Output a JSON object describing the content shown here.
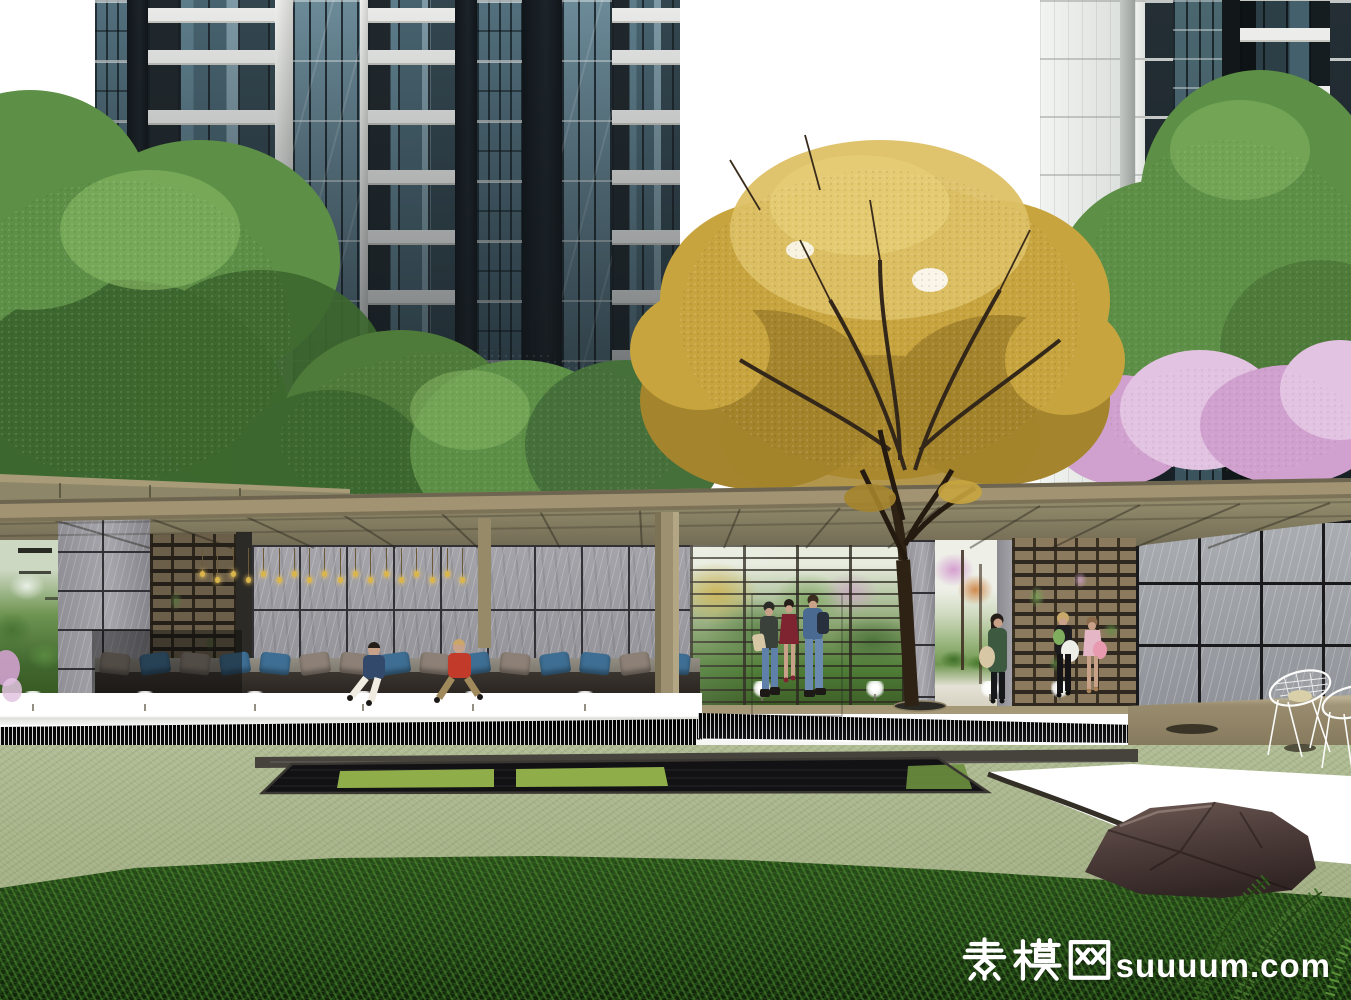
{
  "watermark": {
    "text_cn": "素模网",
    "text_en": "suuuum.com",
    "full": "素模网suuuum.com",
    "color": "#ffffff"
  },
  "scene": {
    "pendant_count": 18,
    "fountain_x": [
      33,
      145,
      255,
      363,
      473,
      585,
      762,
      875,
      990,
      1060
    ],
    "pillows": [
      "gray",
      "blue",
      "gray",
      "blue",
      "blue",
      "gray",
      "gray",
      "blue",
      "gray",
      "blue",
      "gray",
      "blue",
      "blue",
      "gray",
      "blue"
    ]
  },
  "colors": {
    "sky": "#ffffff",
    "lawn": "#a6b288",
    "hedge": "#1c3a12",
    "hedge_light": "#3f7a24",
    "roof_fascia": "#a29472",
    "soffit": "#8a8164",
    "soffit_dark": "#6b6450",
    "column_tan": "#9d9070",
    "deck": "#9a8d6f",
    "deck_face": "#857857",
    "marble": "#9b9ba0",
    "marble_joint": "#323236",
    "marble_right": "#a2a6aa",
    "lattice": "#8b7a5e",
    "lattice_dark": "#2e2820",
    "glass_teal": "#51707d",
    "glass_dark": "#1b2125",
    "slab_white": "#ecedeb",
    "facade_white": "#eef0ee",
    "cascade": "#17171a",
    "water_white": "#f8f8f6",
    "pool_dark": "#121214",
    "pool_green": "#8fae4a",
    "stone_edge": "#46423c",
    "gold": "#c7a43e",
    "gold_light": "#ddc065",
    "gold_dark": "#a4842c",
    "green_tree": "#5d8f46",
    "green_dark": "#3c672e",
    "green_light": "#82b260",
    "pink": "#d0a1cf",
    "pink_light": "#e3c3e2",
    "trunk": "#2e2215",
    "rock": "#503f3c",
    "rock_light": "#6e5a54",
    "fern": "#35631f",
    "pillow_blue": "#3e6e93",
    "pillow_gray": "#8d8177",
    "bench_seat": "#8b867c",
    "bench_face": "#2e2a25",
    "pendant_gold": "#d9b54a",
    "skin": "#c9a189",
    "jeans": "#5f80a8",
    "red_shirt": "#c23b2a",
    "navy": "#33496b",
    "green_coat": "#3d5a40",
    "red_dress": "#7e2430",
    "bag_beige": "#d8c7a4",
    "pink_dress": "#e5b7c6",
    "bag_pink": "#e79ab0",
    "bag_white": "#eeeee8",
    "dark_hair": "#241d18",
    "white": "#ffffff"
  }
}
